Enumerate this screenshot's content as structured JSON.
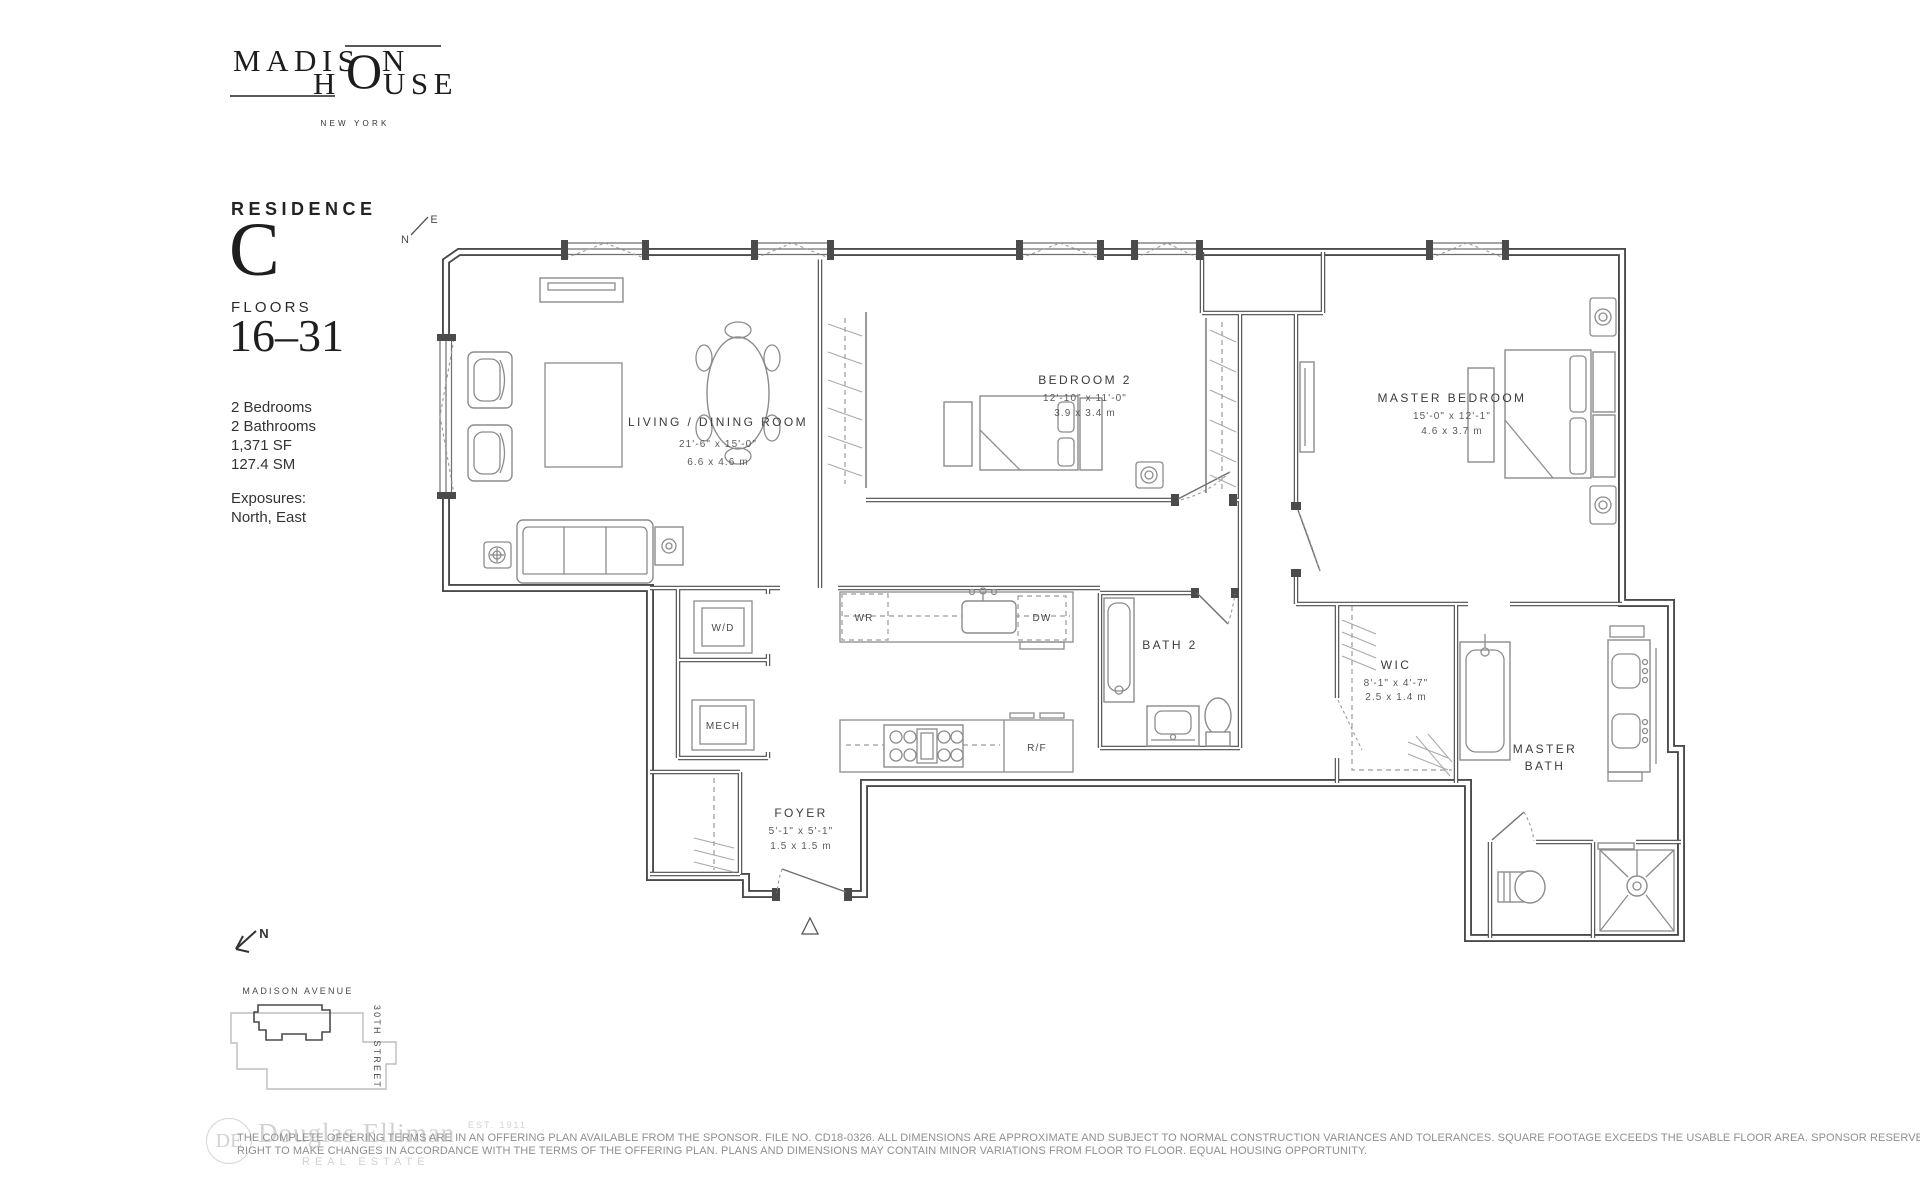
{
  "brand": {
    "top_left": "MADIS",
    "top_right": "N",
    "shared_o": "O",
    "bottom_left": "H",
    "bottom_right": "USE",
    "city": "NEW YORK"
  },
  "residence": {
    "label": "RESIDENCE",
    "unit": "C",
    "floors_label": "FLOORS",
    "floors_range": "16–31",
    "features": [
      "2 Bedrooms",
      "2 Bathrooms",
      "1,371 SF",
      "127.4 SM"
    ],
    "exposures_label": "Exposures:",
    "exposures_value": "North, East"
  },
  "plan_compass": {
    "north": "N",
    "east": "E"
  },
  "rooms": {
    "living_dining": {
      "name": "LIVING / DINING ROOM",
      "imperial": "21'-6\" x 15'-0\"",
      "metric": "6.6 x 4.6 m"
    },
    "bedroom_2": {
      "name": "BEDROOM 2",
      "imperial": "12'-10\" x 11'-0\"",
      "metric": "3.9 x 3.4 m"
    },
    "master_bedroom": {
      "name": "MASTER BEDROOM",
      "imperial": "15'-0\" x 12'-1\"",
      "metric": "4.6 x 3.7 m"
    },
    "bath_2": {
      "name": "BATH 2"
    },
    "master_bath": {
      "line1": "MASTER",
      "line2": "BATH"
    },
    "wic": {
      "name": "WIC",
      "imperial": "8'-1\" x 4'-7\"",
      "metric": "2.5 x 1.4 m"
    },
    "foyer": {
      "name": "FOYER",
      "imperial": "5'-1\" x 5'-1\"",
      "metric": "1.5 x 1.5 m"
    }
  },
  "appliances": {
    "washer_dryer": "W/D",
    "mechanical": "MECH",
    "wine_ref": "WR",
    "dishwasher": "DW",
    "refrigerator": "R/F"
  },
  "site_key": {
    "north": "N",
    "avenue": "MADISON AVENUE",
    "street": "30TH STREET"
  },
  "watermark": {
    "monogram": "DE",
    "name": "Douglas Elliman",
    "established": "EST. 1911",
    "tagline": "REAL ESTATE"
  },
  "disclaimer": {
    "line1": "THE COMPLETE OFFERING TERMS ARE IN AN OFFERING PLAN AVAILABLE FROM THE SPONSOR. FILE NO. CD18-0326. ALL DIMENSIONS ARE APPROXIMATE AND SUBJECT TO NORMAL CONSTRUCTION VARIANCES AND TOLERANCES. SQUARE FOOTAGE EXCEEDS THE USABLE FLOOR AREA. SPONSOR RESERVES THE",
    "line2": "RIGHT TO MAKE CHANGES IN ACCORDANCE WITH THE TERMS OF THE OFFERING PLAN. PLANS AND DIMENSIONS MAY CONTAIN MINOR VARIATIONS FROM FLOOR TO FLOOR.  EQUAL HOUSING OPPORTUNITY."
  }
}
